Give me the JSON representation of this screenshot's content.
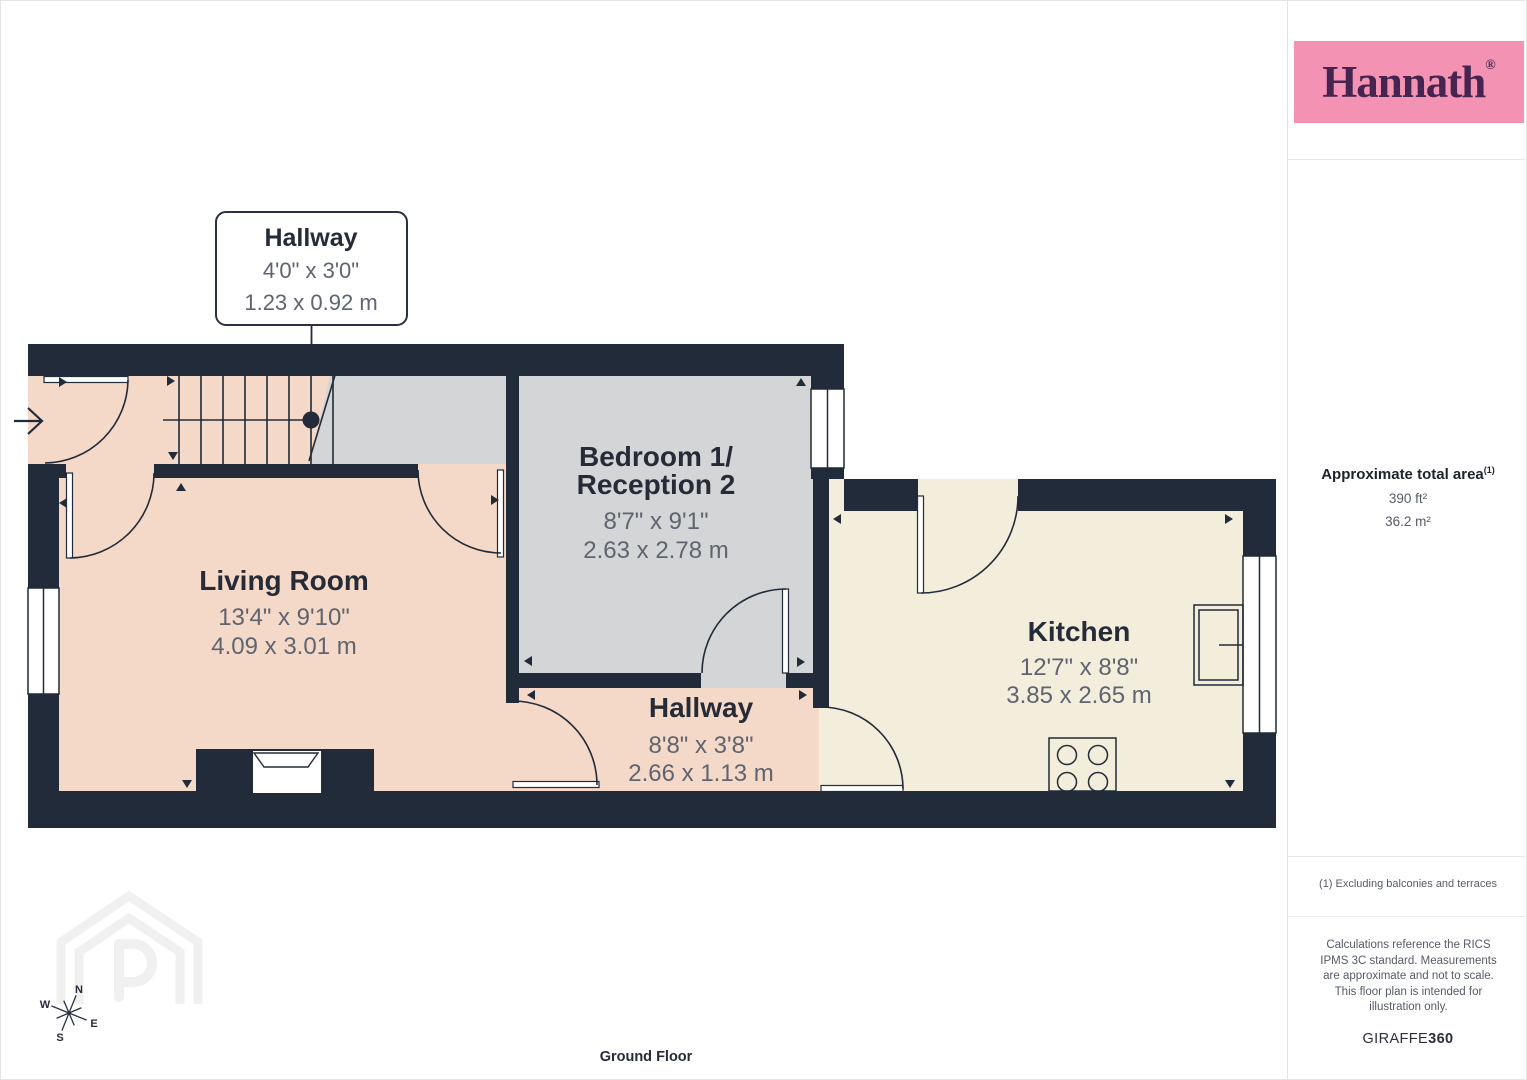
{
  "branding": {
    "logo_text": "Hannath",
    "registered_mark": "®",
    "logo_bg": "#F492B4",
    "logo_color": "#452550"
  },
  "sidebar": {
    "area_title": "Approximate total area",
    "area_footnote_marker": "(1)",
    "area_imperial": "390 ft²",
    "area_metric": "36.2 m²",
    "footnote": "(1) Excluding balconies and terraces",
    "disclaimer": "Calculations reference the RICS IPMS 3C standard. Measurements are approximate and not to scale. This floor plan is intended for illustration only.",
    "brand_regular": "GIRAFFE",
    "brand_bold": "360"
  },
  "plan": {
    "floor_label": "Ground Floor",
    "callout": {
      "title": "Hallway",
      "dims_imperial": "4'0\" x 3'0\"",
      "dims_metric": "1.23 x 0.92 m"
    },
    "rooms": {
      "living": {
        "name": "Living Room",
        "dims_imperial": "13'4\" x 9'10\"",
        "dims_metric": "4.09 x 3.01 m"
      },
      "bedroom": {
        "name_line1": "Bedroom 1/",
        "name_line2": "Reception 2",
        "dims_imperial": "8'7\" x 9'1\"",
        "dims_metric": "2.63 x 2.78 m"
      },
      "kitchen": {
        "name": "Kitchen",
        "dims_imperial": "12'7\" x 8'8\"",
        "dims_metric": "3.85 x 2.65 m"
      },
      "hallway": {
        "name": "Hallway",
        "dims_imperial": "8'8\" x 3'8\"",
        "dims_metric": "2.66 x 1.13 m"
      }
    },
    "compass": {
      "north": "N",
      "east": "E",
      "south": "S",
      "west": "W"
    },
    "colors": {
      "wall": "#212B39",
      "floor_warm": "#F5D9C8",
      "floor_gray": "#D4D5D6",
      "floor_cream": "#F3EDDB",
      "text_dark": "#262B37",
      "text_gray": "#5E6470"
    }
  }
}
